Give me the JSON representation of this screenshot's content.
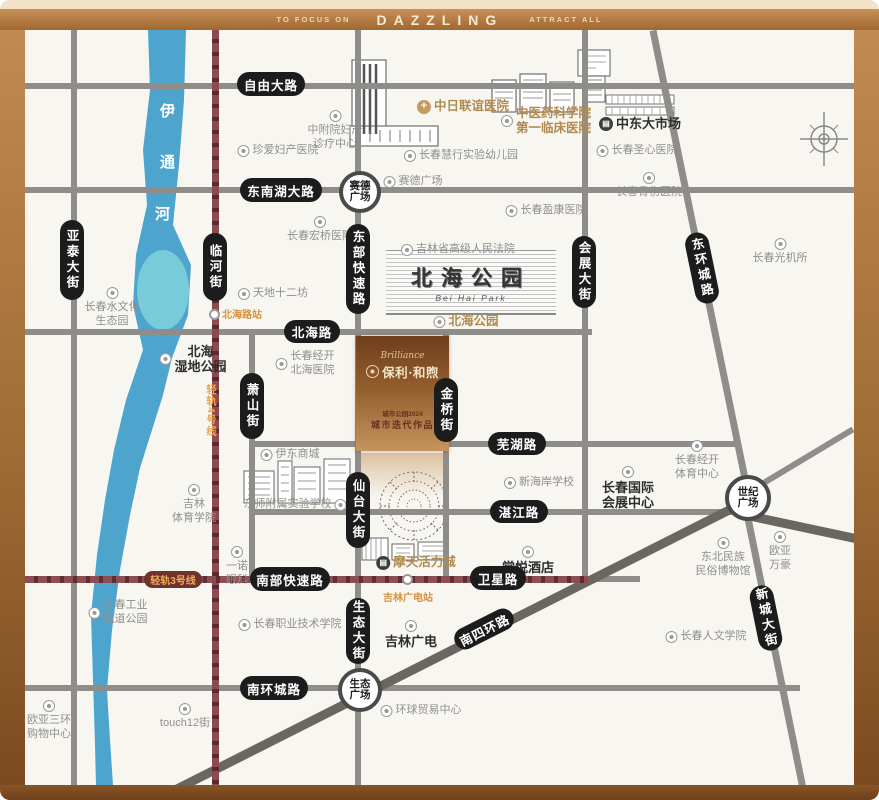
{
  "header": {
    "left": "TO FOCUS ON",
    "title": "DAZZLING",
    "right": "ATTRACT ALL"
  },
  "colors": {
    "frame": "#a9702e",
    "map_bg": "#f8f6f1",
    "road": "#8f8d8a",
    "road_dark": "#6c6660",
    "rail": "#8d4a4f",
    "badge_bg": "#1c1c1c",
    "river": "#3f9ecb",
    "lake": "#80d2da",
    "gold": "#b18a50",
    "station_text": "#d9913f"
  },
  "river": {
    "name": "伊通河",
    "chars": [
      "伊",
      "通",
      "河"
    ]
  },
  "park": {
    "calligraphy": "北海公园",
    "en": "Bei Hai Park"
  },
  "project": {
    "script": "Brilliance",
    "brand": "保利·和煦",
    "tag1": "城市公园2024",
    "tag2": "城市迭代作品"
  },
  "roads": [
    {
      "id": "ziyou-dalu",
      "label": "自由大路",
      "type": "h",
      "x": 25,
      "y": 83,
      "len": 830,
      "badge": [
        237,
        72,
        68,
        24
      ]
    },
    {
      "id": "dongnanhu-dalu",
      "label": "东南湖大路",
      "type": "h",
      "x": 25,
      "y": 187,
      "len": 830,
      "badge": [
        240,
        178,
        82,
        24
      ]
    },
    {
      "id": "beihai-lu",
      "label": "北海路",
      "type": "h",
      "x": 25,
      "y": 329,
      "len": 567,
      "badge": [
        284,
        320,
        56,
        23
      ]
    },
    {
      "id": "wuhu-lu",
      "label": "芜湖路",
      "type": "h",
      "x": 252,
      "y": 441,
      "len": 488,
      "badge": [
        488,
        432,
        58,
        23
      ]
    },
    {
      "id": "zhanjiang-lu",
      "label": "湛江路",
      "type": "h",
      "x": 252,
      "y": 509,
      "len": 488,
      "badge": [
        490,
        500,
        58,
        23
      ]
    },
    {
      "id": "nanbu-kuaisulu",
      "label": "南部快速路",
      "type": "h",
      "x": 25,
      "y": 576,
      "len": 615,
      "badge": [
        250,
        567,
        80,
        24
      ]
    },
    {
      "id": "nanhuan-chenglu",
      "label": "南环城路",
      "type": "h",
      "x": 25,
      "y": 685,
      "len": 775,
      "badge": [
        240,
        676,
        68,
        24
      ]
    },
    {
      "id": "yatai-dajie",
      "label": "亚泰大街",
      "type": "v",
      "x": 71,
      "y": 30,
      "len": 755,
      "badge": [
        60,
        220,
        24,
        80
      ]
    },
    {
      "id": "xiaoshan-jie",
      "label": "萧山街",
      "type": "v",
      "x": 249,
      "y": 332,
      "len": 247,
      "badge": [
        240,
        373,
        24,
        66
      ]
    },
    {
      "id": "dongbu-kuaisulu",
      "label": "东部快速路",
      "type": "v",
      "x": 355,
      "y": 30,
      "len": 755,
      "badge": [
        346,
        224,
        24,
        90
      ]
    },
    {
      "id": "jinqiao-jie",
      "label": "金桥街",
      "type": "v",
      "x": 443,
      "y": 332,
      "len": 247,
      "badge": [
        434,
        378,
        24,
        64
      ]
    },
    {
      "id": "huizhan-dajie",
      "label": "会展大街",
      "type": "v",
      "x": 582,
      "y": 30,
      "len": 549,
      "badge": [
        572,
        236,
        24,
        72
      ]
    },
    {
      "id": "donghuan-chenglu",
      "label": "东环城路",
      "type": "d",
      "x": 653,
      "y": 27,
      "len": 473,
      "angle": 78.4,
      "w": 7,
      "badge": [
        690,
        232,
        24,
        72
      ],
      "brot": -11.6
    },
    {
      "id": "xincheng-dajie",
      "label": "新城大街",
      "type": "d",
      "x": 746,
      "y": 505,
      "len": 291,
      "angle": 78.5,
      "w": 7,
      "badge": [
        754,
        585,
        24,
        66
      ],
      "brot": -11.5
    },
    {
      "id": "nansihuan-lu",
      "label": "南四环路",
      "type": "d",
      "x": 170,
      "y": 788,
      "len": 645,
      "angle": -26.8,
      "w": 9,
      "dark": true,
      "badge": [
        452,
        618,
        64,
        22
      ],
      "brot": -26.8
    },
    {
      "id": "sihuan-east",
      "label": "",
      "type": "d",
      "x": 752,
      "y": 512,
      "len": 106,
      "angle": 12,
      "w": 9,
      "dark": true
    },
    {
      "id": "northeast-diagonal",
      "label": "",
      "type": "d",
      "x": 757,
      "y": 484,
      "len": 112,
      "angle": -31,
      "w": 6
    }
  ],
  "extra_badges": [
    {
      "id": "weixing-lu",
      "label": "卫星路",
      "x": 470,
      "y": 566,
      "w": 56,
      "h": 24
    },
    {
      "id": "xiantai-dajie",
      "label": "仙台大街",
      "x": 346,
      "y": 472,
      "w": 24,
      "h": 76
    },
    {
      "id": "shengtai-dajie",
      "label": "生态大街",
      "x": 346,
      "y": 598,
      "w": 24,
      "h": 66
    },
    {
      "id": "linhe-jie",
      "label": "临河街",
      "x": 203,
      "y": 233,
      "w": 24,
      "h": 68
    }
  ],
  "rails": [
    {
      "id": "rail-line-4",
      "label": "轻轨4号线",
      "orient": "v",
      "x": 212,
      "y": 30,
      "len": 755,
      "w": 7,
      "text_pos": [
        204,
        384
      ],
      "station": {
        "id": "beihailu-station",
        "label": "北海路站",
        "dot": [
          209,
          309
        ],
        "label_pos": [
          222,
          306
        ]
      }
    },
    {
      "id": "rail-line-3",
      "label": "轻轨3号线",
      "orient": "h",
      "x": 25,
      "y": 576,
      "len": 563,
      "w": 7,
      "badge": [
        144,
        571,
        58,
        17
      ],
      "station": {
        "id": "jilinguangdian-station",
        "label": "吉林广电站",
        "dot": [
          402,
          574
        ],
        "label_pos": [
          383,
          589
        ]
      }
    }
  ],
  "plazas": [
    {
      "id": "saide-plaza",
      "lines": [
        "赛德",
        "广场"
      ],
      "x": 360,
      "y": 192,
      "r": 21
    },
    {
      "id": "shiji-plaza",
      "lines": [
        "世纪",
        "广场"
      ],
      "x": 748,
      "y": 498,
      "r": 23
    },
    {
      "id": "shengtai-plaza",
      "lines": [
        "生态",
        "广场"
      ],
      "x": 360,
      "y": 690,
      "r": 22
    }
  ],
  "pois": [
    {
      "id": "zhongfuyuan-center",
      "lines": [
        "中附院妇产",
        "诊疗中心"
      ],
      "x": 335,
      "y": 110,
      "style": "gray",
      "icon": "ring",
      "ipos": "top"
    },
    {
      "id": "zhenai-hospital",
      "lines": [
        "珍爱妇产医院"
      ],
      "x": 278,
      "y": 144,
      "style": "gray",
      "icon": "ring",
      "ipos": "left"
    },
    {
      "id": "zhongri-hospital",
      "lines": [
        "中日联谊医院"
      ],
      "x": 463,
      "y": 99,
      "style": "gold",
      "icon": "cross",
      "ipos": "left"
    },
    {
      "id": "zhongyiyao-hospital",
      "lines": [
        "中医药科学院",
        "第一临床医院"
      ],
      "x": 546,
      "y": 106,
      "style": "gold",
      "icon": "ring",
      "ipos": "left"
    },
    {
      "id": "huixing-kindergarten",
      "lines": [
        "长春慧行实验幼儿园"
      ],
      "x": 461,
      "y": 149,
      "style": "gray",
      "icon": "ring",
      "ipos": "left"
    },
    {
      "id": "saide-plaza-label",
      "lines": [
        "赛德广场"
      ],
      "x": 413,
      "y": 175,
      "style": "gray",
      "icon": "ring",
      "ipos": "left"
    },
    {
      "id": "zhongdong-market",
      "lines": [
        "中东大市场"
      ],
      "x": 640,
      "y": 116,
      "style": "bold",
      "icon": "dark",
      "ipos": "left"
    },
    {
      "id": "shengxin-hospital",
      "lines": [
        "长春圣心医院"
      ],
      "x": 637,
      "y": 144,
      "style": "gray",
      "icon": "ring",
      "ipos": "left"
    },
    {
      "id": "gushang-hospital",
      "lines": [
        "长春骨伤医院"
      ],
      "x": 649,
      "y": 172,
      "style": "gray",
      "icon": "ring",
      "ipos": "top"
    },
    {
      "id": "hongqiao-hospital",
      "lines": [
        "长春宏桥医院"
      ],
      "x": 320,
      "y": 216,
      "style": "gray",
      "icon": "ring",
      "ipos": "top"
    },
    {
      "id": "yingkang-hospital",
      "lines": [
        "长春盈康医院"
      ],
      "x": 546,
      "y": 204,
      "style": "gray",
      "icon": "ring",
      "ipos": "left"
    },
    {
      "id": "high-court",
      "lines": [
        "吉林省高级人民法院"
      ],
      "x": 458,
      "y": 243,
      "style": "gray",
      "icon": "ring",
      "ipos": "left"
    },
    {
      "id": "guangjisuo",
      "lines": [
        "长春光机所"
      ],
      "x": 780,
      "y": 238,
      "style": "gray",
      "icon": "ring",
      "ipos": "top"
    },
    {
      "id": "water-culture-park",
      "lines": [
        "长春水文化",
        "生态园"
      ],
      "x": 112,
      "y": 287,
      "style": "gray",
      "icon": "ring",
      "ipos": "top"
    },
    {
      "id": "tiandi-12fang",
      "lines": [
        "天地十二坊"
      ],
      "x": 273,
      "y": 287,
      "style": "gray",
      "icon": "ring",
      "ipos": "left"
    },
    {
      "id": "beihai-park-label",
      "lines": [
        "北海公园"
      ],
      "x": 466,
      "y": 314,
      "style": "gold",
      "icon": "ring",
      "ipos": "left"
    },
    {
      "id": "jingkai-beihai-hospital",
      "lines": [
        "长春经开",
        "北海医院"
      ],
      "x": 305,
      "y": 350,
      "style": "gray",
      "icon": "ring",
      "ipos": "left"
    },
    {
      "id": "beihai-wetland-park",
      "lines": [
        "北海",
        "湿地公园"
      ],
      "x": 193,
      "y": 344,
      "style": "bold",
      "icon": "ring",
      "ipos": "left"
    },
    {
      "id": "yidong-mall",
      "lines": [
        "伊东商城"
      ],
      "x": 290,
      "y": 448,
      "style": "gray",
      "icon": "ring",
      "ipos": "left"
    },
    {
      "id": "dongshi-school",
      "lines": [
        "东师附属实验学校"
      ],
      "x": 295,
      "y": 498,
      "style": "gray",
      "icon": "ring",
      "ipos": "right"
    },
    {
      "id": "jilin-sport-college",
      "lines": [
        "吉林",
        "体育学院"
      ],
      "x": 194,
      "y": 484,
      "style": "gray",
      "icon": "ring",
      "ipos": "top"
    },
    {
      "id": "yinuo-eye-clinic",
      "lines": [
        "一诺",
        "眼科"
      ],
      "x": 237,
      "y": 546,
      "style": "gray",
      "icon": "ring",
      "ipos": "top"
    },
    {
      "id": "xinhaian-school",
      "lines": [
        "新海岸学校"
      ],
      "x": 539,
      "y": 476,
      "style": "gray",
      "icon": "ring",
      "ipos": "left"
    },
    {
      "id": "tangyue-hotel",
      "lines": [
        "棠悦酒店"
      ],
      "x": 528,
      "y": 546,
      "style": "bold",
      "icon": "ring",
      "ipos": "top"
    },
    {
      "id": "motian-vitality-city",
      "lines": [
        "摩天活力城"
      ],
      "x": 416,
      "y": 555,
      "style": "gold",
      "icon": "dark",
      "ipos": "left"
    },
    {
      "id": "intl-convention-center",
      "lines": [
        "长春国际",
        "会展中心"
      ],
      "x": 628,
      "y": 466,
      "style": "bold",
      "icon": "ring",
      "ipos": "top"
    },
    {
      "id": "jingkai-sports-center",
      "lines": [
        "长春经开",
        "体育中心"
      ],
      "x": 697,
      "y": 440,
      "style": "gray",
      "icon": "ring",
      "ipos": "top"
    },
    {
      "id": "folk-museum",
      "lines": [
        "东北民族",
        "民俗博物馆"
      ],
      "x": 723,
      "y": 537,
      "style": "gray",
      "icon": "ring",
      "ipos": "top"
    },
    {
      "id": "ouya-wanhao",
      "lines": [
        "欧亚",
        "万豪"
      ],
      "x": 780,
      "y": 531,
      "style": "gray",
      "icon": "ring",
      "ipos": "top"
    },
    {
      "id": "renwen-college",
      "lines": [
        "长春人文学院"
      ],
      "x": 706,
      "y": 630,
      "style": "gray",
      "icon": "ring",
      "ipos": "left"
    },
    {
      "id": "jilin-guangdian",
      "lines": [
        "吉林广电"
      ],
      "x": 411,
      "y": 620,
      "style": "bold",
      "icon": "ring",
      "ipos": "top"
    },
    {
      "id": "vocational-college",
      "lines": [
        "长春职业技术学院"
      ],
      "x": 290,
      "y": 618,
      "style": "gray",
      "icon": "ring",
      "ipos": "left"
    },
    {
      "id": "industry-rail-park",
      "lines": [
        "长春工业",
        "轨道公园"
      ],
      "x": 118,
      "y": 599,
      "style": "gray",
      "icon": "ring",
      "ipos": "left"
    },
    {
      "id": "touch12-street",
      "lines": [
        "touch12街"
      ],
      "x": 185,
      "y": 703,
      "style": "gray",
      "icon": "ring",
      "ipos": "top"
    },
    {
      "id": "ouya-sanhuan-mall",
      "lines": [
        "欧亚三环",
        "购物中心"
      ],
      "x": 49,
      "y": 700,
      "style": "gray",
      "icon": "ring",
      "ipos": "top"
    },
    {
      "id": "global-trade-center",
      "lines": [
        "环球贸易中心"
      ],
      "x": 421,
      "y": 704,
      "style": "gray",
      "icon": "ring",
      "ipos": "left"
    }
  ]
}
